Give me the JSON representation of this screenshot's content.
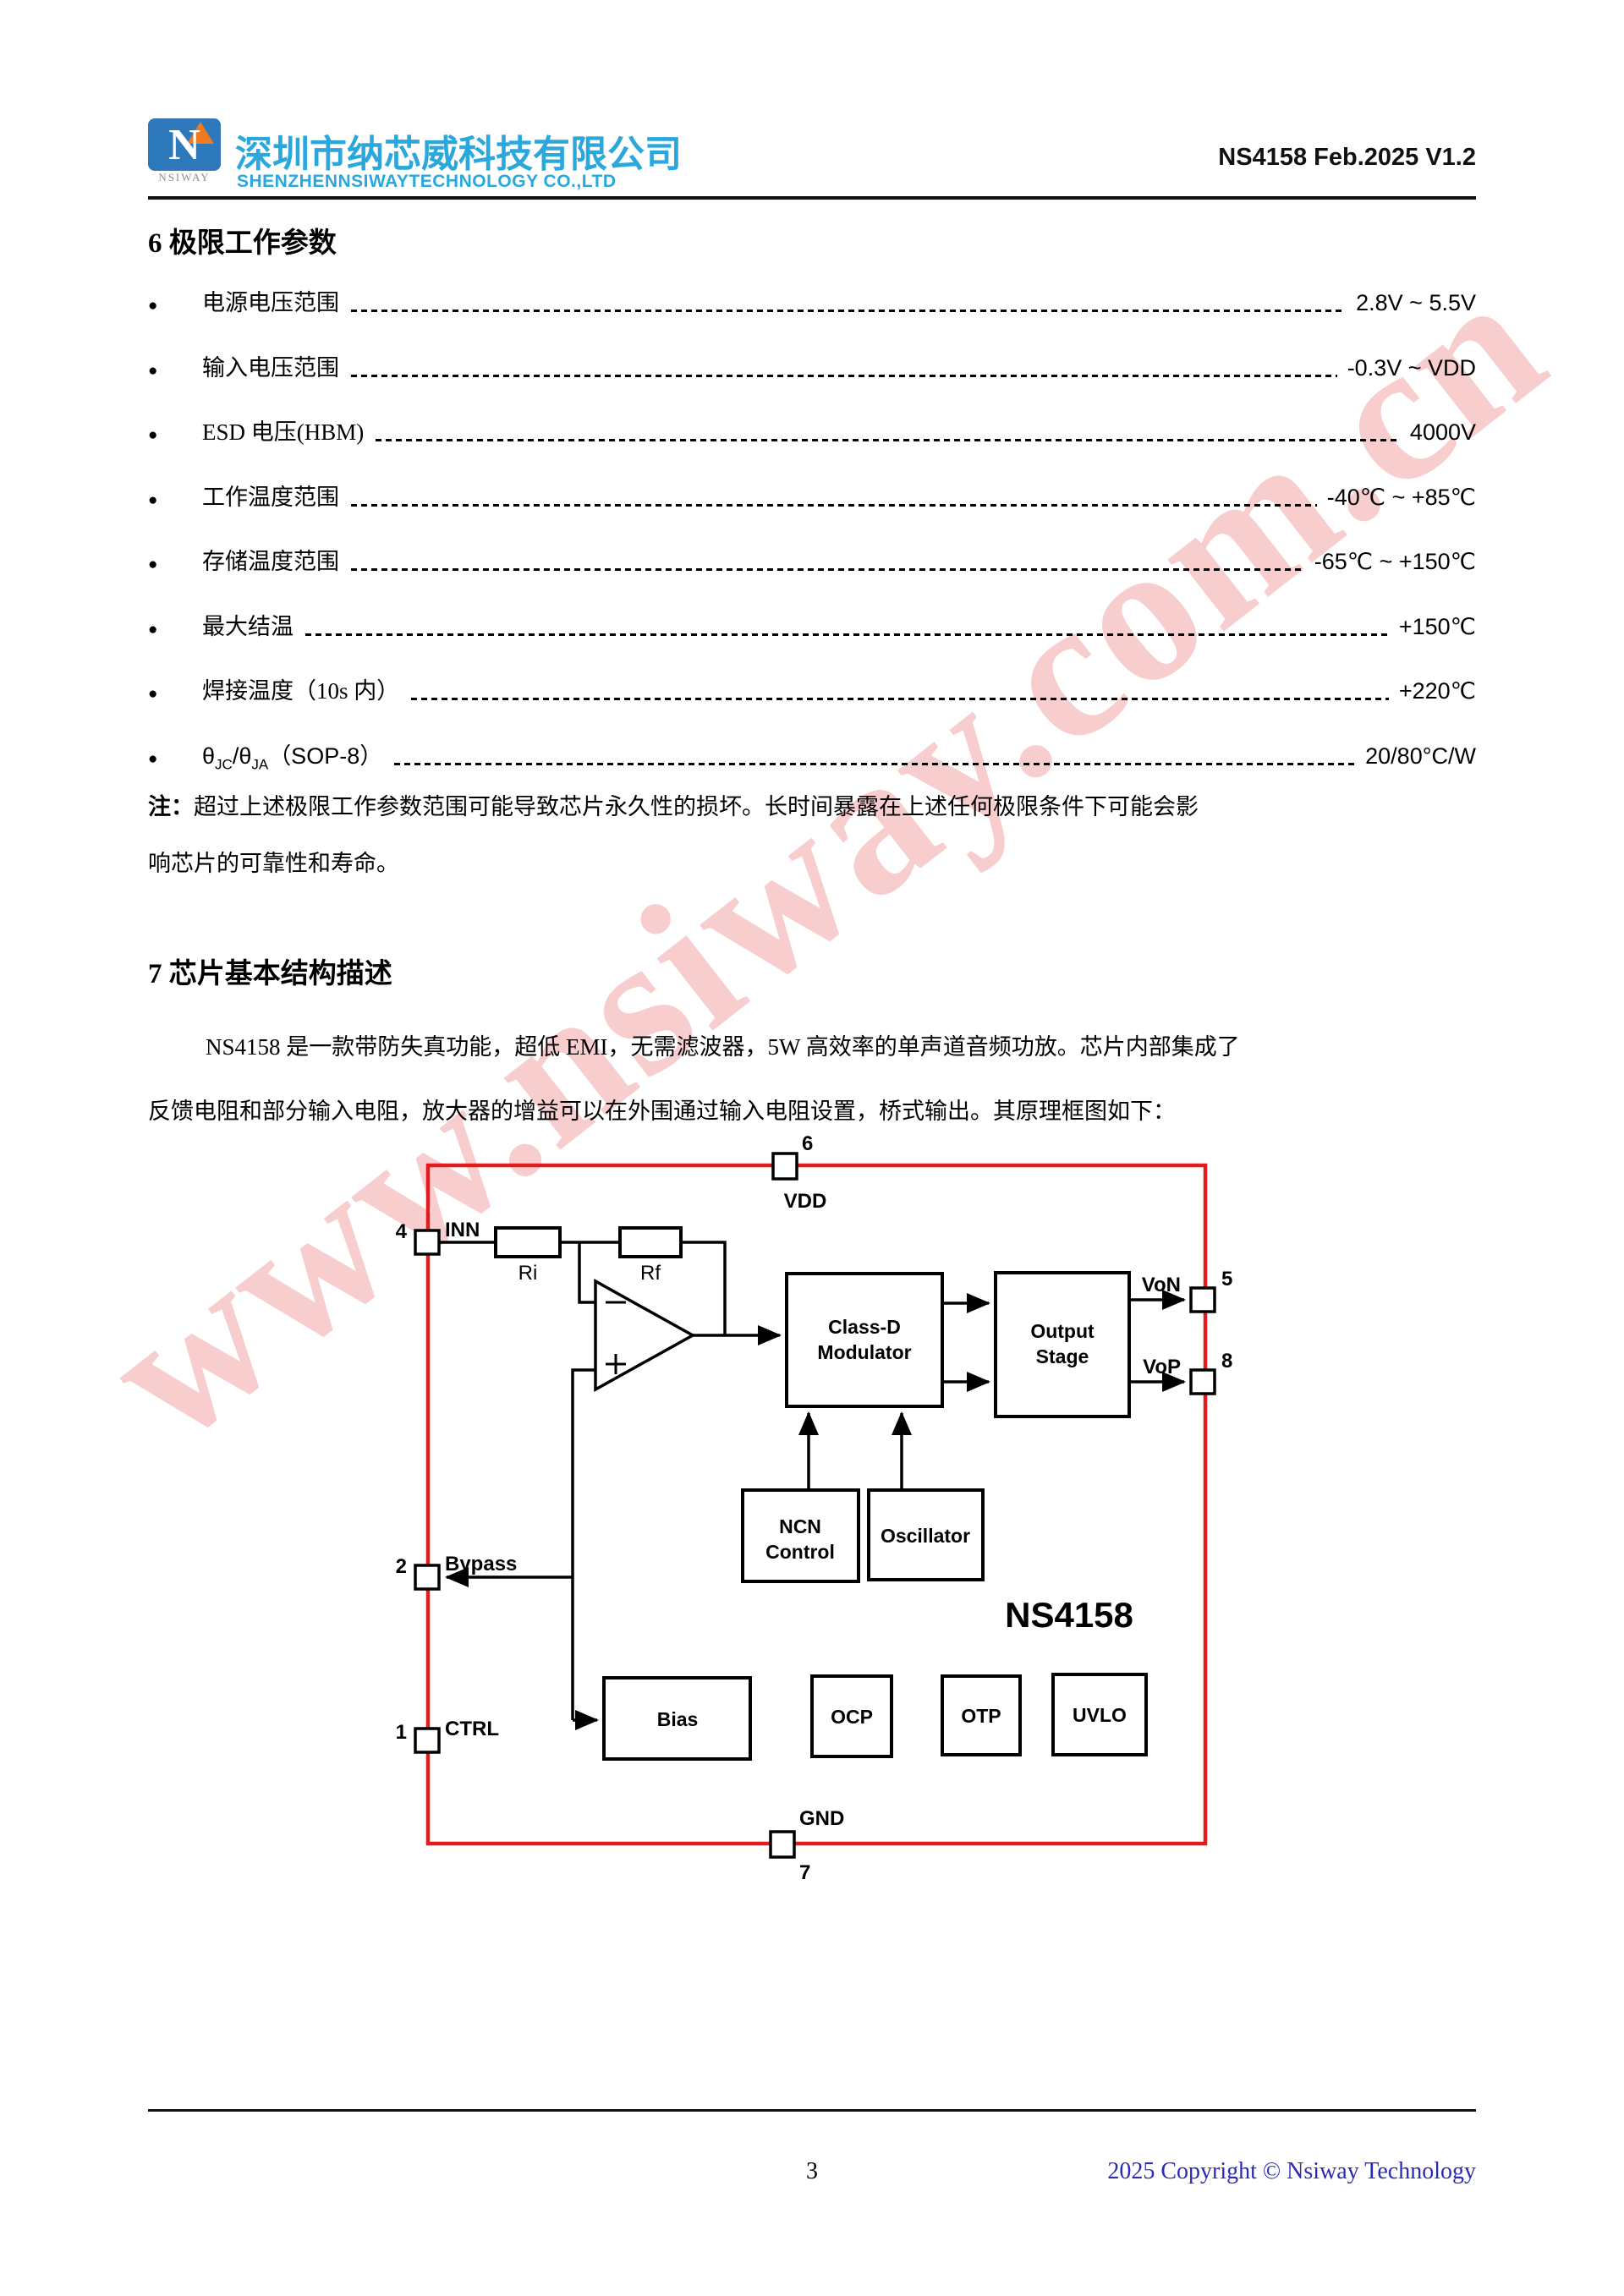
{
  "header": {
    "logo_text": "NSIWAY",
    "company_cn": "深圳市纳芯威科技有限公司",
    "company_en": "SHENZHENNSIWAYTECHNOLOGY CO.,LTD",
    "doc_version": "NS4158 Feb.2025 V1.2"
  },
  "watermark": {
    "text": "www.nsiway.com.cn"
  },
  "section6": {
    "title": "6 极限工作参数",
    "items": [
      {
        "label": "电源电压范围",
        "value": "2.8V ~ 5.5V"
      },
      {
        "label": "输入电压范围",
        "value": "-0.3V ~ VDD"
      },
      {
        "label": "ESD 电压(HBM)",
        "value": "4000V"
      },
      {
        "label": "工作温度范围",
        "value": "-40℃ ~ +85℃"
      },
      {
        "label": "存储温度范围",
        "value": "-65℃ ~ +150℃"
      },
      {
        "label": "最大结温",
        "value": "+150℃"
      },
      {
        "label": "焊接温度（10s 内）",
        "value": "+220℃"
      },
      {
        "label_p1": "θ",
        "label_s1": "JC",
        "label_p2": "/θ",
        "label_s2": "JA",
        "label_p3": "（SOP-8）",
        "value": "20/80°C/W"
      }
    ],
    "note_prefix": "注：",
    "note_line1": "超过上述极限工作参数范围可能导致芯片永久性的损坏。长时间暴露在上述任何极限条件下可能会影",
    "note_line2": "响芯片的可靠性和寿命。"
  },
  "section7": {
    "title": "7 芯片基本结构描述",
    "para_line1": "NS4158 是一款带防失真功能，超低 EMI，无需滤波器，5W 高效率的单声道音频功放。芯片内部集成了",
    "para_line2": "反馈电阻和部分输入电阻，放大器的增益可以在外围通过输入电阻设置，桥式输出。其原理框图如下："
  },
  "diagram": {
    "chip_name": "NS4158",
    "pin_vdd": {
      "num": "6",
      "label": "VDD"
    },
    "pin_inn": {
      "num": "4",
      "label": "INN"
    },
    "pin_bypass": {
      "num": "2",
      "label": "Bypass"
    },
    "pin_ctrl": {
      "num": "1",
      "label": "CTRL"
    },
    "pin_von": {
      "num": "5",
      "label": "VoN"
    },
    "pin_vop": {
      "num": "8",
      "label": "VoP"
    },
    "pin_gnd": {
      "num": "7",
      "label": "GND"
    },
    "resistor_ri": "Ri",
    "resistor_rf": "Rf",
    "block_classd_line1": "Class-D",
    "block_classd_line2": "Modulator",
    "block_output_line1": "Output",
    "block_output_line2": "Stage",
    "block_ncn_line1": "NCN",
    "block_ncn_line2": "Control",
    "block_oscillator": "Oscillator",
    "block_bias": "Bias",
    "block_ocp": "OCP",
    "block_otp": "OTP",
    "block_uvlo": "UVLO"
  },
  "footer": {
    "page_number": "3",
    "copyright": "2025 Copyright © Nsiway Technology"
  },
  "colors": {
    "accent_blue": "#2AA7DC",
    "logo_blue": "#2E79BC",
    "logo_orange": "#EF7B21",
    "diagram_border_red": "#E11B1E",
    "watermark_pink": "#F8CDCD",
    "footer_blue": "#2A2AB8"
  }
}
